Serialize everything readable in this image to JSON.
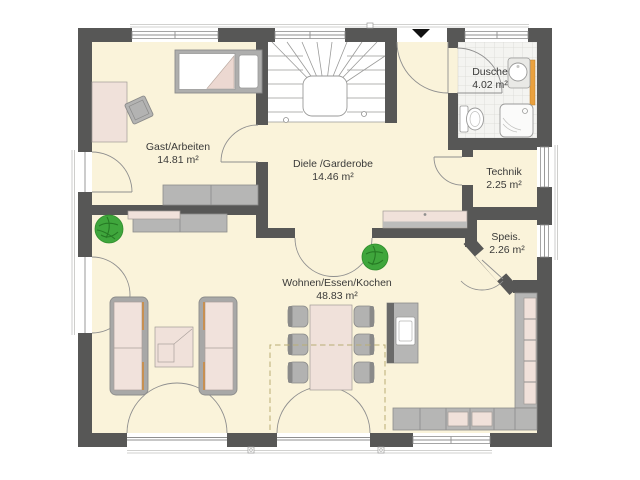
{
  "rooms": [
    {
      "name": "Gast/Arbeiten",
      "area": "14.81 m²"
    },
    {
      "name": "Diele /Garderobe",
      "area": "14.46 m²"
    },
    {
      "name": "Dusche",
      "area": "4.02 m²"
    },
    {
      "name": "Technik",
      "area": "2.25 m²"
    },
    {
      "name": "Speis.",
      "area": "2.26 m²"
    },
    {
      "name": "Wohnen/Essen/Kochen",
      "area": "48.83 m²"
    }
  ],
  "icons": {
    "entrance_marker": "down-arrow"
  },
  "colors": {
    "wall": "#575756",
    "floor": "#faf3da",
    "stair_floor": "#ffffff",
    "tile": "#f4f4f1",
    "furniture_gray": "#b6b6b5",
    "furniture_pink": "#f0e1da",
    "plant_green": "#3fa63c",
    "radiator_orange": "#eaa13e",
    "label_text": "#3a3a39"
  }
}
